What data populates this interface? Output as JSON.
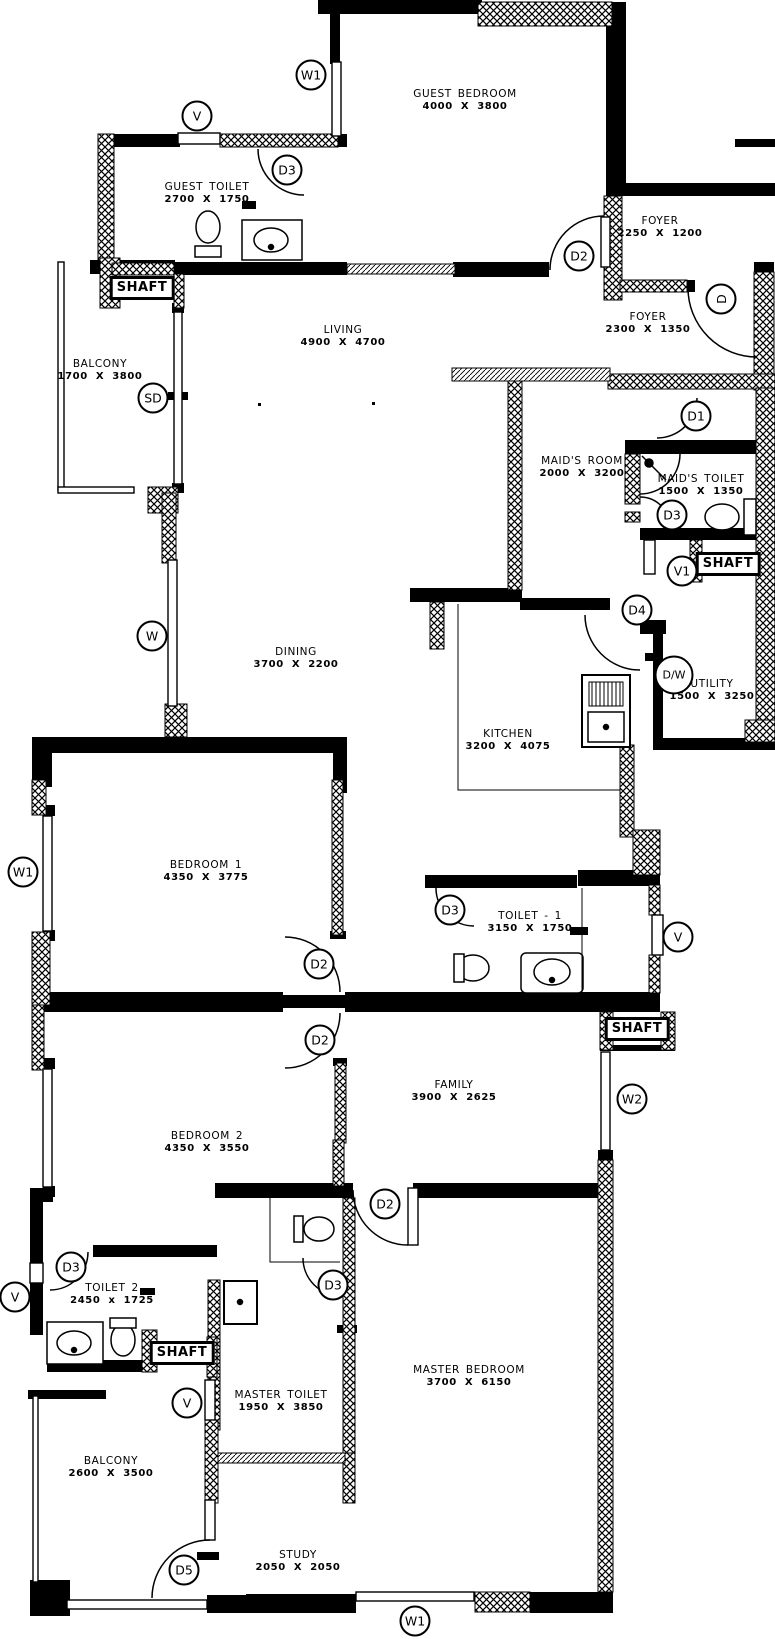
{
  "plan_title": "Apartment Floor Plan",
  "colors": {
    "wall": "#000000",
    "background": "#ffffff"
  },
  "plan": {
    "rooms": [
      {
        "name": "GUEST BEDROOM",
        "dims": "4000 X 3800",
        "x": 465,
        "y": 100
      },
      {
        "name": "GUEST TOILET",
        "dims": "2700 X 1750",
        "x": 207,
        "y": 193
      },
      {
        "name": "FOYER",
        "dims": "2250 X 1200",
        "x": 660,
        "y": 227
      },
      {
        "name": "FOYER",
        "dims": "2300 X 1350",
        "x": 648,
        "y": 323
      },
      {
        "name": "LIVING",
        "dims": "4900 X 4700",
        "x": 343,
        "y": 336
      },
      {
        "name": "BALCONY",
        "dims": "1700 X 3800",
        "x": 100,
        "y": 370
      },
      {
        "name": "MAID'S ROOM",
        "dims": "2000 X 3200",
        "x": 582,
        "y": 467
      },
      {
        "name": "MAID'S TOILET",
        "dims": "1500 X 1350",
        "x": 701,
        "y": 485
      },
      {
        "name": "UTILITY",
        "dims": "1500 X 3250",
        "x": 712,
        "y": 690
      },
      {
        "name": "DINING",
        "dims": "3700 X 2200",
        "x": 296,
        "y": 658
      },
      {
        "name": "KITCHEN",
        "dims": "3200 X 4075",
        "x": 508,
        "y": 740
      },
      {
        "name": "BEDROOM 1",
        "dims": "4350 X 3775",
        "x": 206,
        "y": 871
      },
      {
        "name": "TOILET - 1",
        "dims": "3150 X 1750",
        "x": 530,
        "y": 922
      },
      {
        "name": "FAMILY",
        "dims": "3900 X 2625",
        "x": 454,
        "y": 1091
      },
      {
        "name": "BEDROOM 2",
        "dims": "4350 X 3550",
        "x": 207,
        "y": 1142
      },
      {
        "name": "TOILET 2",
        "dims": "2450 x 1725",
        "x": 112,
        "y": 1294
      },
      {
        "name": "MASTER TOILET",
        "dims": "1950 X 3850",
        "x": 281,
        "y": 1401
      },
      {
        "name": "MASTER BEDROOM",
        "dims": "3700 X 6150",
        "x": 469,
        "y": 1376
      },
      {
        "name": "BALCONY",
        "dims": "2600 X 3500",
        "x": 111,
        "y": 1467
      },
      {
        "name": "STUDY",
        "dims": "2050 X 2050",
        "x": 298,
        "y": 1561
      }
    ],
    "shafts": [
      {
        "label": "SHAFT",
        "x": 142,
        "y": 288
      },
      {
        "label": "SHAFT",
        "x": 728,
        "y": 564
      },
      {
        "label": "SHAFT",
        "x": 637,
        "y": 1029
      },
      {
        "label": "SHAFT",
        "x": 182,
        "y": 1353
      }
    ],
    "markers": [
      {
        "label": "W1",
        "x": 311,
        "y": 75
      },
      {
        "label": "V",
        "x": 197,
        "y": 116
      },
      {
        "label": "D3",
        "x": 287,
        "y": 170
      },
      {
        "label": "D2",
        "x": 579,
        "y": 256
      },
      {
        "label": "D",
        "x": 721,
        "y": 299,
        "rotate": true
      },
      {
        "label": "D1",
        "x": 696,
        "y": 416
      },
      {
        "label": "D3",
        "x": 672,
        "y": 515
      },
      {
        "label": "V1",
        "x": 682,
        "y": 571
      },
      {
        "label": "D4",
        "x": 637,
        "y": 610
      },
      {
        "label": "D/W",
        "x": 674,
        "y": 675
      },
      {
        "label": "SD",
        "x": 153,
        "y": 398
      },
      {
        "label": "W",
        "x": 152,
        "y": 636
      },
      {
        "label": "W1",
        "x": 23,
        "y": 872
      },
      {
        "label": "D2",
        "x": 319,
        "y": 964
      },
      {
        "label": "D2",
        "x": 320,
        "y": 1040
      },
      {
        "label": "D3",
        "x": 450,
        "y": 910
      },
      {
        "label": "V",
        "x": 678,
        "y": 937
      },
      {
        "label": "W2",
        "x": 632,
        "y": 1099
      },
      {
        "label": "D2",
        "x": 385,
        "y": 1204
      },
      {
        "label": "D3",
        "x": 71,
        "y": 1267
      },
      {
        "label": "V",
        "x": 15,
        "y": 1297
      },
      {
        "label": "D3",
        "x": 333,
        "y": 1285
      },
      {
        "label": "V",
        "x": 187,
        "y": 1403
      },
      {
        "label": "D5",
        "x": 184,
        "y": 1570
      },
      {
        "label": "W1",
        "x": 415,
        "y": 1621
      }
    ]
  }
}
